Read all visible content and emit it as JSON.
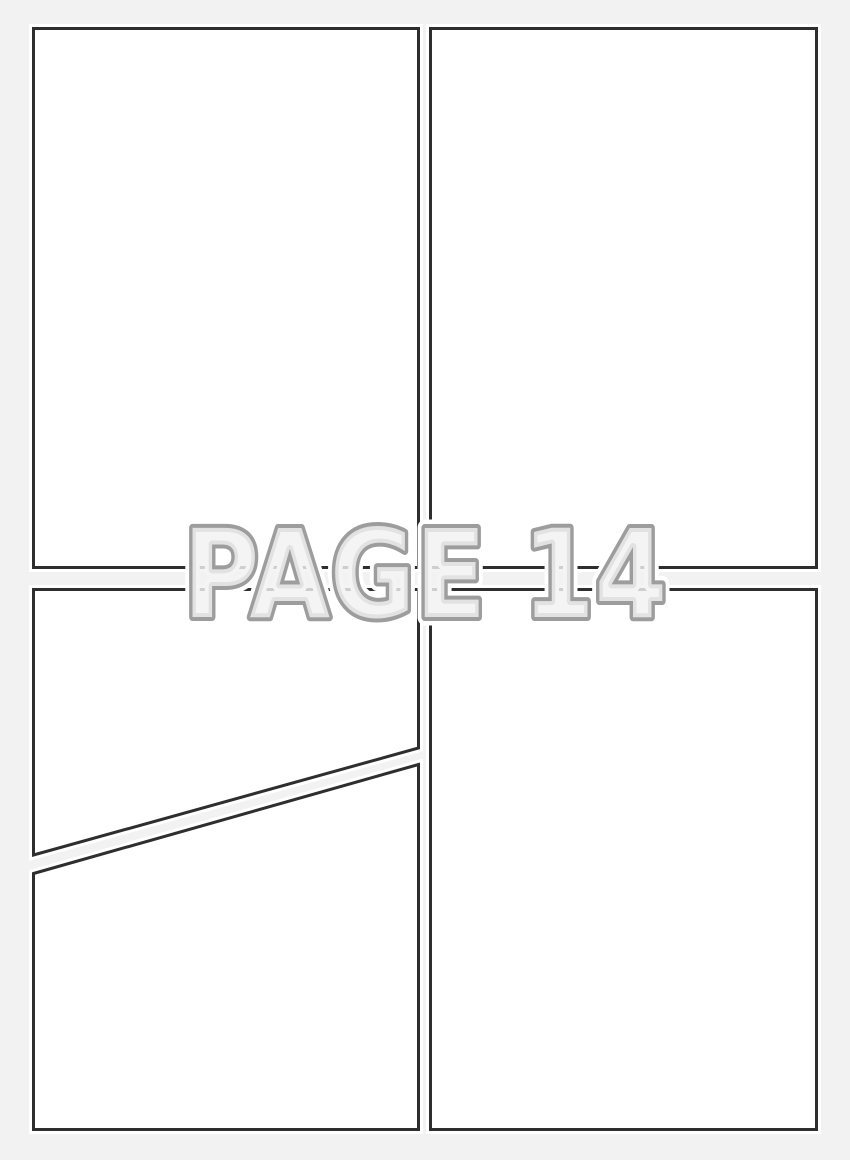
{
  "watermark": {
    "label": "PAGE 14"
  },
  "panels": {
    "count": 4,
    "layout": "2x2 grid, bottom-left panel split by diagonal gutter",
    "ids": [
      "top-left",
      "top-right",
      "bottom-left-upper",
      "bottom-left-lower",
      "bottom-right"
    ]
  },
  "colors": {
    "page_background": "#f2f2f2",
    "panel_fill": "#ffffff",
    "panel_border": "#2e2e2e",
    "panel_halo": "#ffffff",
    "watermark_stroke": "#9d9d9d",
    "watermark_halo": "#ffffff",
    "watermark_fill_rgba": "rgba(242,242,242,0.82)"
  }
}
